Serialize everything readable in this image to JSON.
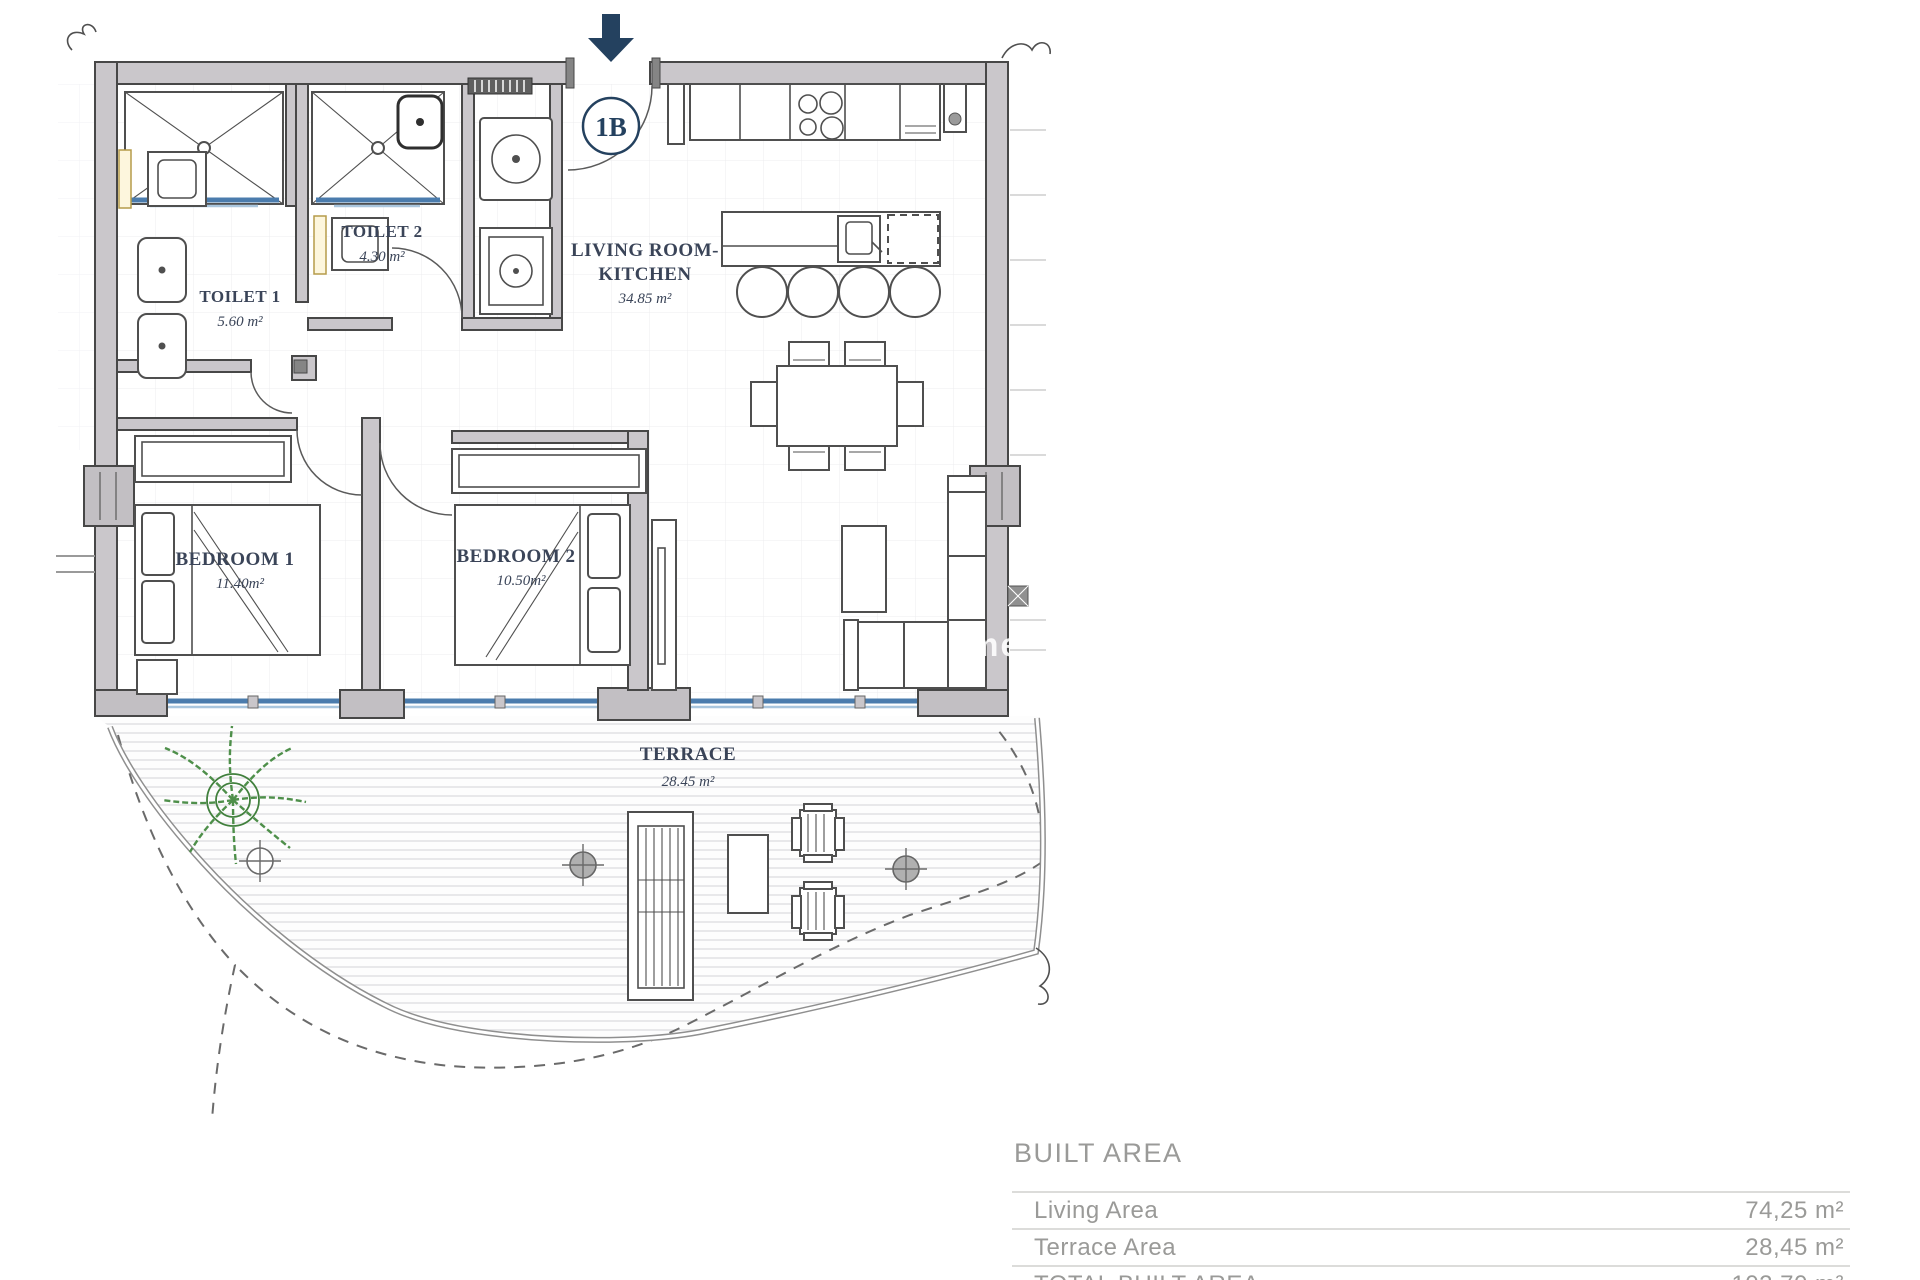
{
  "unit": {
    "label": "1B"
  },
  "rooms": {
    "toilet1": {
      "name": "TOILET 1",
      "area": "5.60 m²"
    },
    "toilet2": {
      "name": "TOILET 2",
      "area": "4.30 m²"
    },
    "living": {
      "line1": "LIVING ROOM-",
      "line2": "KITCHEN",
      "area": "34.85 m²"
    },
    "bedroom1": {
      "name": "BEDROOM 1",
      "area": "11.40m²"
    },
    "bedroom2": {
      "name": "BEDROOM 2",
      "area": "10.50m²"
    },
    "terrace": {
      "name": "TERRACE",
      "area": "28.45 m²"
    }
  },
  "watermark": "me",
  "area_table": {
    "title": "BUILT AREA",
    "rows": [
      {
        "label": "Living Area",
        "value": "74,25 m²"
      },
      {
        "label": "Terrace Area",
        "value": "28,45 m²"
      },
      {
        "label": "TOTAL BUILT AREA",
        "value": "102,70 m²"
      }
    ]
  },
  "colors": {
    "wall": "#cac7cb",
    "line": "#4f4f4f",
    "glass_blue": "#4b7cad",
    "navy": "#24415f",
    "label_text": "#3a4458",
    "table_text": "#9a9a98",
    "plant_green": "#4e8f4a"
  }
}
